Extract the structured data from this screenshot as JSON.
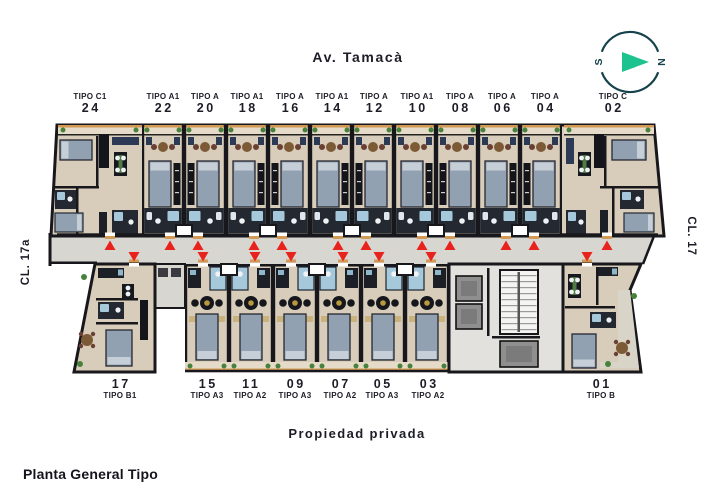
{
  "title": "Planta General Tipo",
  "streets": {
    "top": "Av. Tamacà",
    "bottom": "Propiedad privada",
    "left": "CL. 17a",
    "right": "CL. 17"
  },
  "compass": {
    "s": "S",
    "n": "N",
    "ring_color": "#16424c",
    "arrow_color": "#1dc38e"
  },
  "colors": {
    "text": "#1d1d27",
    "wall": "#17171c",
    "floor": "#d8ccba",
    "balcony": "#e6dbc9",
    "corridor": "#d7d6d1",
    "orange": "#d29a55",
    "bed": "#92a1b1",
    "pillow": "#c6ced8",
    "bed_stroke": "#262830",
    "bath_dark": "#232831",
    "bath_blue": "#a5c8da",
    "fixture": "#eef2f4",
    "wardrobe": "#14151a",
    "table_brown": "#7c5a35",
    "chair_red": "#6b4034",
    "chair_navy": "#2c3a55",
    "plant": "#47823c",
    "kitchen": "#1c1f26",
    "core_floor": "#e2e1dd",
    "stair_floor": "#f4f4f2",
    "elevator": "#8f8f8f",
    "red": "#e8231d",
    "gold": "#b9983f",
    "nightstand": "#c9b27e"
  },
  "plan": {
    "band_top": {
      "y1": 125,
      "y2": 236
    },
    "band_bottom": {
      "y1": 264,
      "y2": 372
    },
    "corridor": {
      "poly": [
        [
          51,
          236
        ],
        [
          654,
          236
        ],
        [
          643,
          264
        ],
        [
          51,
          264
        ]
      ],
      "left_wall_x": 51
    },
    "top_outline": [
      [
        57,
        125
      ],
      [
        654,
        125
      ],
      [
        664,
        236
      ],
      [
        51,
        236
      ]
    ],
    "top_units": [
      {
        "num": "24",
        "tipo": "TIPO C1",
        "x1": 57,
        "x2": 142,
        "lx": 90,
        "door": 110,
        "kind": "c1"
      },
      {
        "num": "22",
        "tipo": "TIPO A1",
        "x1": 142,
        "x2": 184,
        "lx": 163,
        "door": 170,
        "kind": "a",
        "m": "r"
      },
      {
        "num": "20",
        "tipo": "TIPO A",
        "x1": 184,
        "x2": 226,
        "lx": 205,
        "door": 198,
        "kind": "a",
        "m": "l"
      },
      {
        "num": "18",
        "tipo": "TIPO A1",
        "x1": 226,
        "x2": 268,
        "lx": 247,
        "door": 254,
        "kind": "a",
        "m": "r"
      },
      {
        "num": "16",
        "tipo": "TIPO A",
        "x1": 268,
        "x2": 310,
        "lx": 290,
        "door": 282,
        "kind": "a",
        "m": "l"
      },
      {
        "num": "14",
        "tipo": "TIPO A1",
        "x1": 310,
        "x2": 352,
        "lx": 332,
        "door": 338,
        "kind": "a",
        "m": "r"
      },
      {
        "num": "12",
        "tipo": "TIPO A",
        "x1": 352,
        "x2": 394,
        "lx": 374,
        "door": 366,
        "kind": "a",
        "m": "l"
      },
      {
        "num": "10",
        "tipo": "TIPO A1",
        "x1": 394,
        "x2": 436,
        "lx": 417,
        "door": 422,
        "kind": "a",
        "m": "r"
      },
      {
        "num": "08",
        "tipo": "TIPO A",
        "x1": 436,
        "x2": 478,
        "lx": 460,
        "door": 450,
        "kind": "a",
        "m": "l"
      },
      {
        "num": "06",
        "tipo": "TIPO A",
        "x1": 478,
        "x2": 520,
        "lx": 502,
        "door": 506,
        "kind": "a",
        "m": "r"
      },
      {
        "num": "04",
        "tipo": "TIPO A",
        "x1": 520,
        "x2": 562,
        "lx": 545,
        "door": 534,
        "kind": "a",
        "m": "l"
      },
      {
        "num": "02",
        "tipo": "TIPO C",
        "x1": 562,
        "x2": 654,
        "lx": 613,
        "door": 607,
        "kind": "c"
      }
    ],
    "bottom_units": [
      {
        "num": "17",
        "tipo": "TIPO B1",
        "lx": 120,
        "door": 134,
        "kind": "b1",
        "poly": [
          [
            95,
            264
          ],
          [
            155,
            264
          ],
          [
            155,
            372
          ],
          [
            74,
            372
          ]
        ]
      },
      {
        "num": "15",
        "tipo": "TIPO A3",
        "x1": 185,
        "x2": 229,
        "lx": 207,
        "door": 203,
        "kind": "ab",
        "m": "r"
      },
      {
        "num": "11",
        "tipo": "TIPO A2",
        "x1": 229,
        "x2": 273,
        "lx": 250,
        "door": 255,
        "kind": "ab",
        "m": "l"
      },
      {
        "num": "09",
        "tipo": "TIPO A3",
        "x1": 273,
        "x2": 317,
        "lx": 295,
        "door": 291,
        "kind": "ab",
        "m": "r"
      },
      {
        "num": "07",
        "tipo": "TIPO A2",
        "x1": 317,
        "x2": 361,
        "lx": 340,
        "door": 343,
        "kind": "ab",
        "m": "l"
      },
      {
        "num": "05",
        "tipo": "TIPO A3",
        "x1": 361,
        "x2": 405,
        "lx": 382,
        "door": 379,
        "kind": "ab",
        "m": "r"
      },
      {
        "num": "03",
        "tipo": "TIPO A2",
        "x1": 405,
        "x2": 449,
        "lx": 428,
        "door": 431,
        "kind": "ab",
        "m": "l"
      },
      {
        "num": "01",
        "tipo": "TIPO B",
        "lx": 601,
        "door": 587,
        "kind": "b",
        "poly": [
          [
            563,
            264
          ],
          [
            641,
            264
          ],
          [
            630,
            290
          ],
          [
            641,
            372
          ],
          [
            563,
            372
          ]
        ]
      }
    ],
    "core": {
      "x1": 449,
      "x2": 563,
      "y1": 264,
      "y2": 372
    },
    "storage": {
      "x": 155,
      "y": 264,
      "w": 30,
      "h": 44
    },
    "pair_walls_top": [
      184,
      268,
      352,
      436,
      520
    ],
    "pair_walls_bottom": [
      229,
      317,
      405
    ],
    "up_triangles": [
      110,
      170,
      198,
      254,
      282,
      338,
      366,
      422,
      450,
      506,
      534,
      607
    ],
    "down_triangles": [
      134,
      203,
      255,
      291,
      343,
      379,
      431,
      587
    ]
  }
}
